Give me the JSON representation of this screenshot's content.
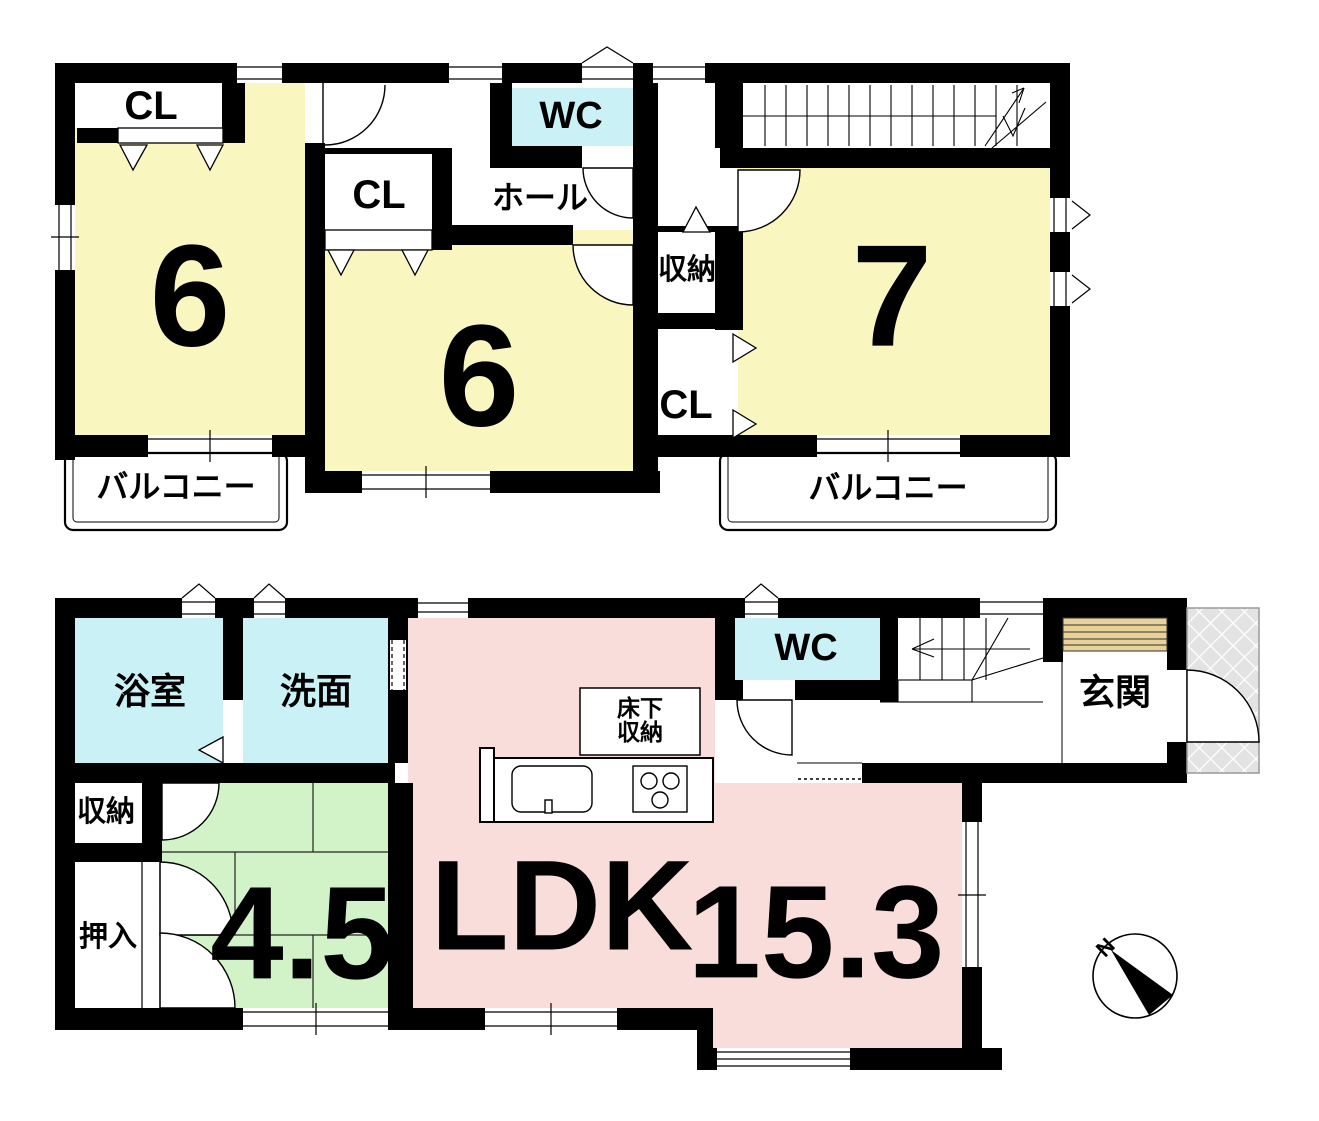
{
  "floor2": {
    "closet_top_left": "CL",
    "bedroom_left": "6",
    "closet_mid": "CL",
    "hall": "ホール",
    "toilet": "WC",
    "bedroom_mid": "6",
    "storage": "収納",
    "closet_right": "CL",
    "bedroom_right": "7",
    "balcony_left": "バルコニー",
    "balcony_right": "バルコニー"
  },
  "floor1": {
    "bathroom": "浴室",
    "washroom": "洗面",
    "toilet": "WC",
    "entrance": "玄関",
    "storage": "収納",
    "futon_closet": "押入",
    "tatami_size": "4.5",
    "ldk_label": "LDK",
    "ldk_size": "15.3",
    "underfloor_storage_line1": "床下",
    "underfloor_storage_line2": "収納"
  },
  "compass": {
    "north": "N"
  },
  "colors": {
    "room_yellow": "#FAF6C0",
    "room_cyan": "#C9F1F6",
    "room_pink": "#F9DDDB",
    "room_green": "#D2F2C8",
    "wall_black": "#000000",
    "genkan_step_tan": "#E8D29A",
    "porch_gray": "#E3E3E3"
  }
}
